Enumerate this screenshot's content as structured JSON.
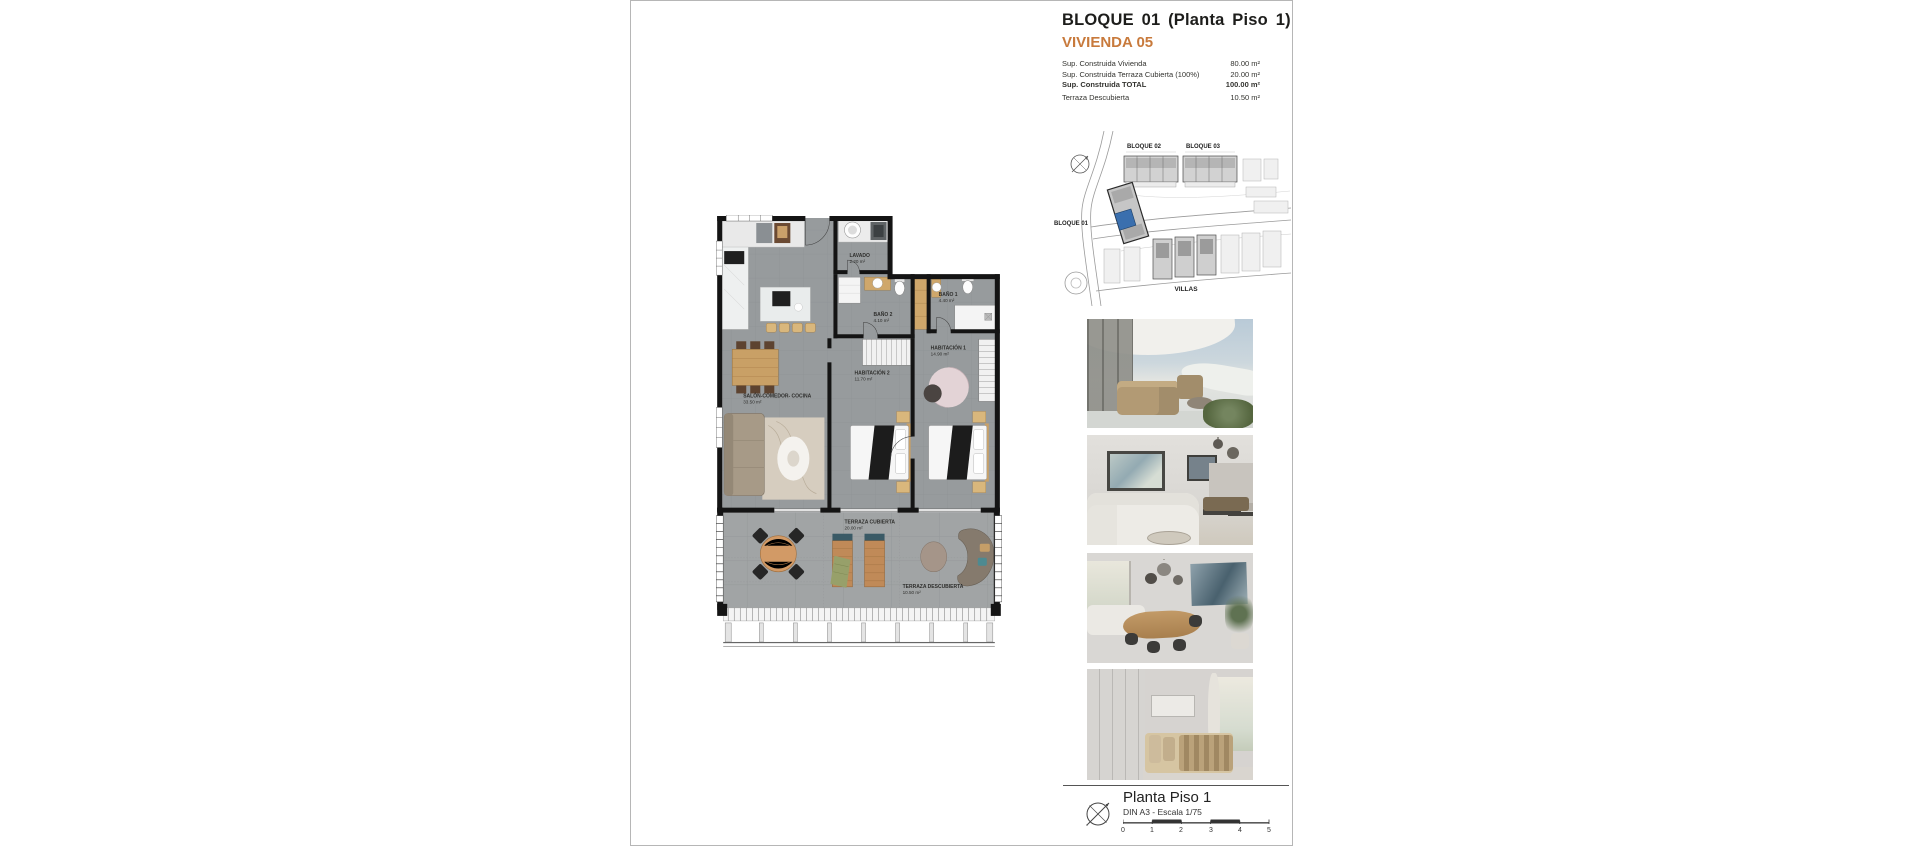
{
  "header": {
    "title": "BLOQUE 01 (Planta Piso 1)",
    "subtitle": "VIVIENDA 05",
    "accent_color": "#c87a3c"
  },
  "areas": {
    "rows": [
      {
        "label": "Sup. Construida Vivienda",
        "value": "80.00 m²"
      },
      {
        "label": "Sup. Construida Terraza Cubierta (100%)",
        "value": "20.00 m²"
      },
      {
        "label": "Sup. Construida TOTAL",
        "value": "100.00 m²"
      },
      {
        "label": "Terraza Descubierta",
        "value": "10.50 m²"
      }
    ]
  },
  "site_plan": {
    "labels": {
      "bloque02": "BLOQUE 02",
      "bloque03": "BLOQUE 03",
      "bloque01": "BLOQUE 01",
      "villas": "VILLAS"
    },
    "highlight_color": "#3a6fae"
  },
  "floor_plan": {
    "rooms": [
      {
        "name": "LAVADO",
        "area": "2.20 m²"
      },
      {
        "name": "BAÑO 2",
        "area": "4.10 m²"
      },
      {
        "name": "BAÑO 1",
        "area": "4.40 m²"
      },
      {
        "name": "HABITACIÓN 1",
        "area": "14.90 m²"
      },
      {
        "name": "HABITACIÓN 2",
        "area": "11.70 m²"
      },
      {
        "name": "SALÓN-COMEDOR- COCINA",
        "area": "33.50 m²"
      },
      {
        "name": "TERRAZA CUBIERTA",
        "area": "20.00 m²"
      },
      {
        "name": "TERRAZA DESCUBIERTA",
        "area": "10.50 m²"
      }
    ]
  },
  "photos": [
    {
      "name": "terrace-exterior-render"
    },
    {
      "name": "living-room-render"
    },
    {
      "name": "dining-room-render"
    },
    {
      "name": "bedroom-render"
    }
  ],
  "legend": {
    "title": "Planta Piso 1",
    "subtitle": "DIN A3 - Escala 1/75",
    "scale_numbers": [
      "0",
      "1",
      "2",
      "3",
      "4",
      "5"
    ]
  }
}
